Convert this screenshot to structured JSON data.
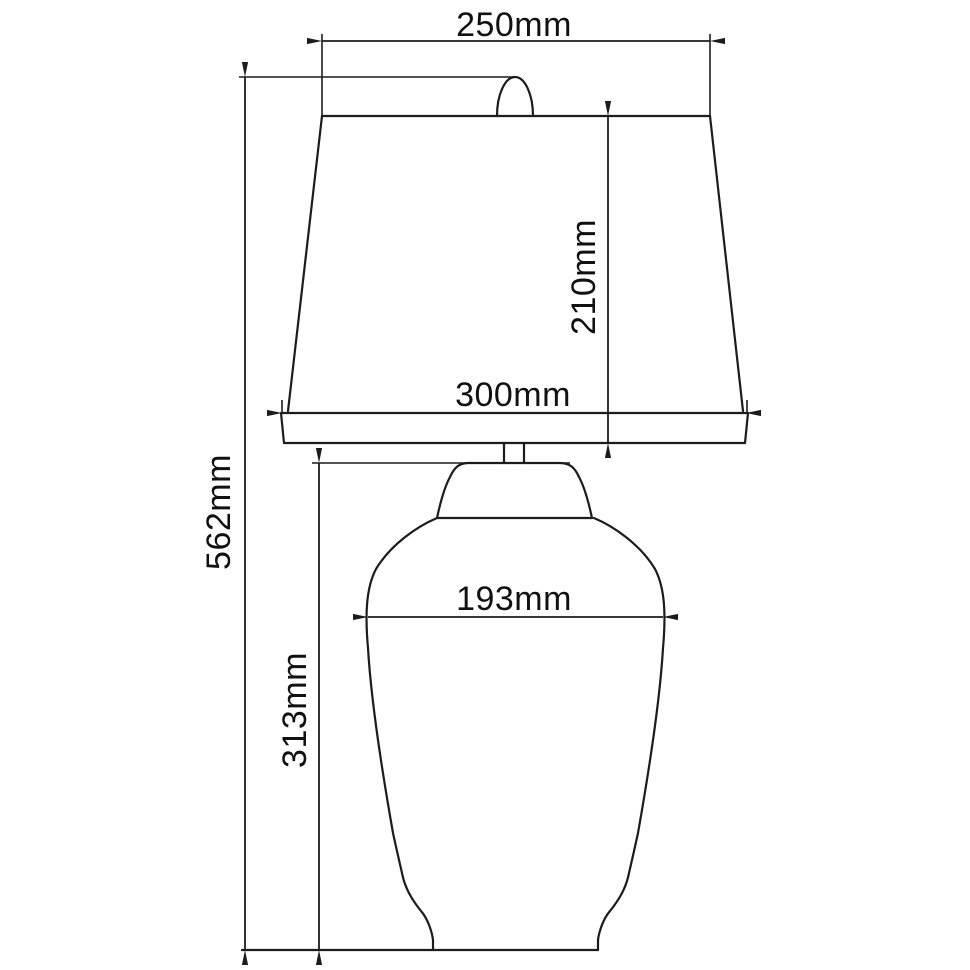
{
  "dimensions": {
    "shade_top_width": "250mm",
    "shade_height": "210mm",
    "shade_bottom_width": "300mm",
    "total_height": "562mm",
    "base_height": "313mm",
    "base_width": "193mm"
  },
  "colors": {
    "line": "#1c1c1c",
    "text": "#111111",
    "background": "#ffffff"
  }
}
